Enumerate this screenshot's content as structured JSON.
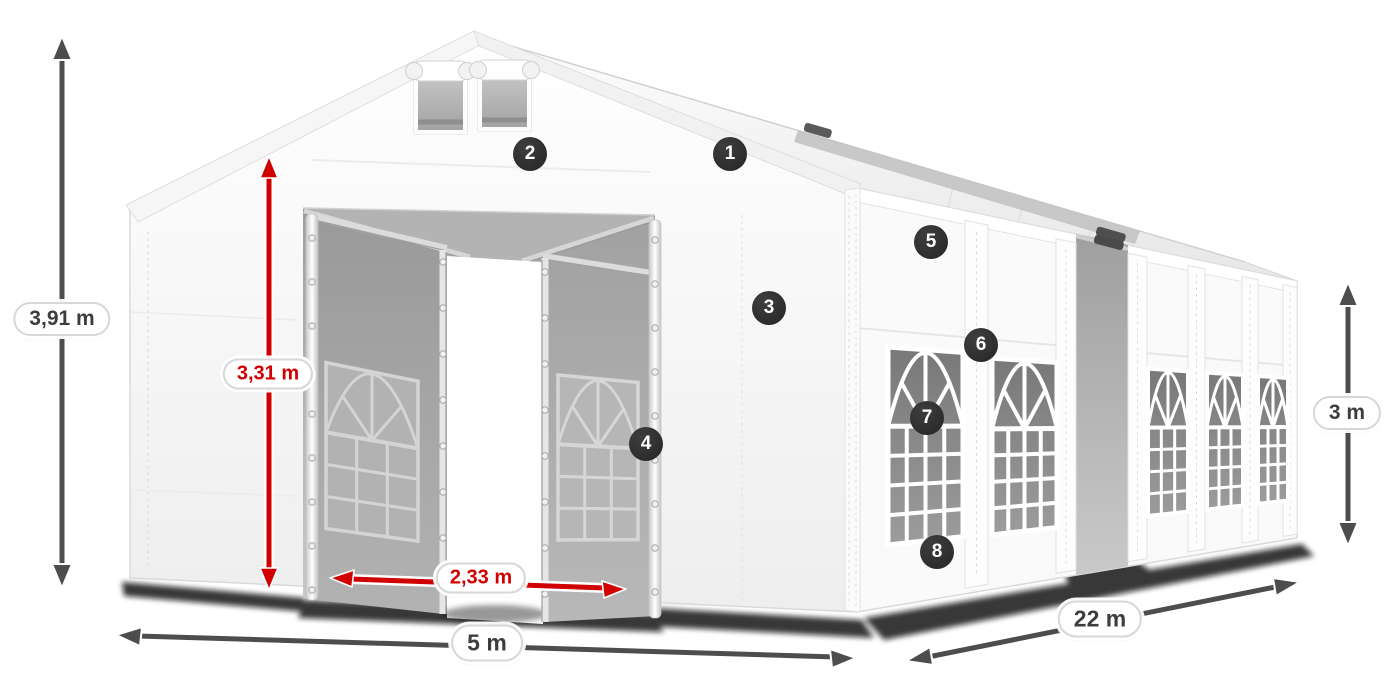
{
  "diagram": {
    "subject": "party-tent-with-dimensions",
    "badges": [
      {
        "label": "1"
      },
      {
        "label": "2"
      },
      {
        "label": "3"
      },
      {
        "label": "4"
      },
      {
        "label": "5"
      },
      {
        "label": "6"
      },
      {
        "label": "7"
      },
      {
        "label": "8"
      }
    ],
    "dimensions": {
      "total_height": {
        "label": "3,91 m"
      },
      "entrance_height": {
        "label": "3,31 m"
      },
      "entrance_width": {
        "label": "2,33 m"
      },
      "width": {
        "label": "5 m"
      },
      "length": {
        "label": "22 m"
      },
      "side_height": {
        "label": "3 m"
      }
    },
    "colors": {
      "accent_red": "#d10000",
      "arrow_gray": "#4d4d4d",
      "badge_background": "#2d2d2d",
      "label_text": "#3d3d3d",
      "tent_white": "#fafafa"
    }
  }
}
